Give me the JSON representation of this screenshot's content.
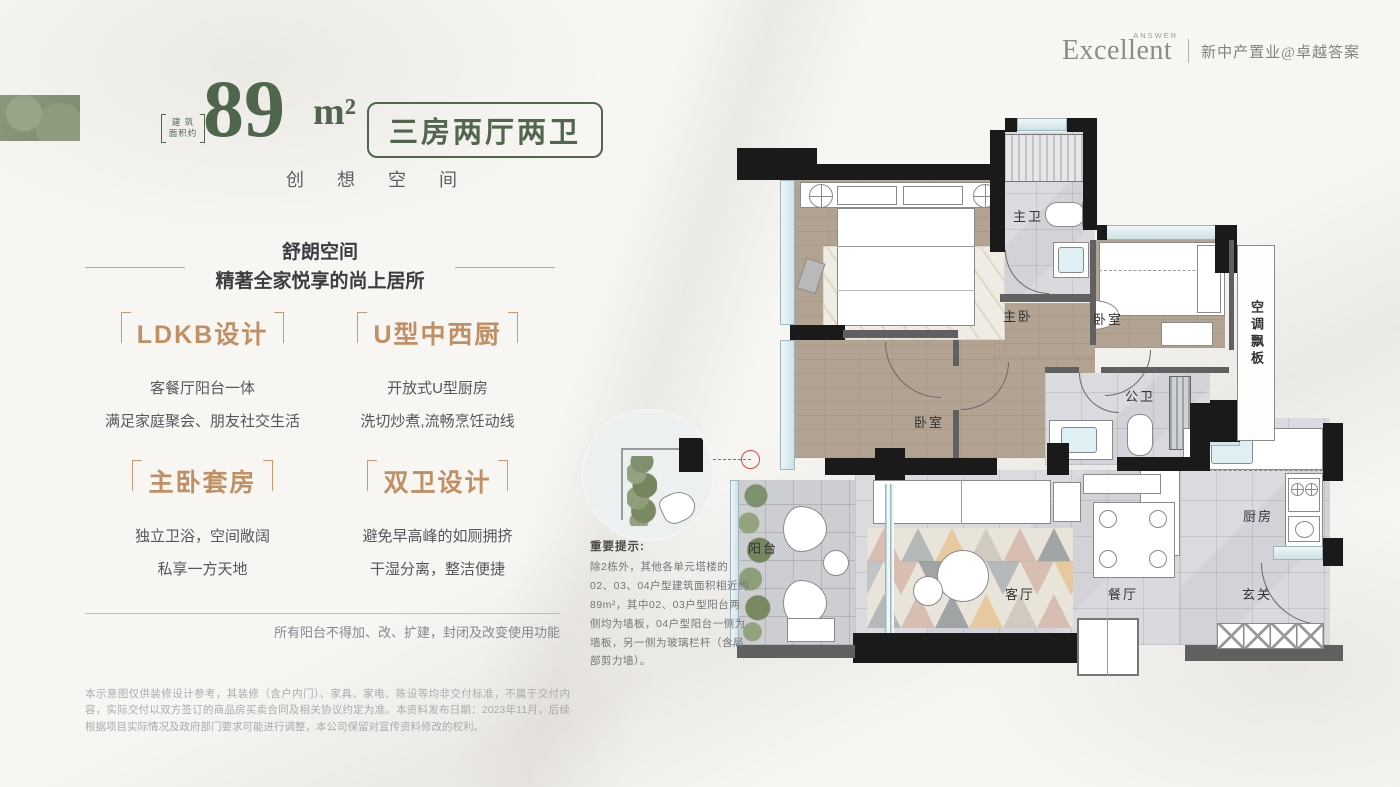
{
  "logo": {
    "brand": "Excellent",
    "brand_sub": "ANSWER",
    "tagline": "新中产置业@卓越答案"
  },
  "hero": {
    "area_label": "建 筑 面积约",
    "area_value": "89",
    "area_unit": "m²",
    "layout_badge": "三房两厅两卫",
    "slogan": "创 想 空 间"
  },
  "intro": {
    "line1": "舒朗空间",
    "line2": "精著全家悦享的尚上居所"
  },
  "features": [
    {
      "title": "LDKB设计",
      "desc1": "客餐厅阳台一体",
      "desc2": "满足家庭聚会、朋友社交生活"
    },
    {
      "title": "U型中西厨",
      "desc1": "开放式U型厨房",
      "desc2": "洗切炒煮,流畅烹饪动线"
    },
    {
      "title": "主卧套房",
      "desc1": "独立卫浴，空间敞阔",
      "desc2": "私享一方天地"
    },
    {
      "title": "双卫设计",
      "desc1": "避免早高峰的如厕拥挤",
      "desc2": "干湿分离，整洁便捷"
    }
  ],
  "balcony_note": "所有阳台不得加、改、扩建，封闭及改变使用功能",
  "disclaimer": "本示意图仅供装修设计参考，其装修（含户内门）、家具、家电、陈设等均非交付标准，不属于交付内容，实际交付以双方签订的商品房买卖合同及相关协议约定为准。本资料发布日期：2023年11月，后续根据项目实际情况及政府部门要求可能进行调整，本公司保留对宣传资料修改的权利。",
  "floorplan": {
    "labels": {
      "master_bath": "主卫",
      "master_bed": "主卧",
      "bedroom_right": "卧室",
      "bedroom_left": "卧室",
      "public_bath": "公卫",
      "ac_panel": "空调飘板",
      "balcony": "阳台",
      "living": "客厅",
      "dining": "餐厅",
      "kitchen": "厨房",
      "foyer": "玄关"
    },
    "note_title": "重要提示:",
    "note_body": "除2栋外，其他各单元塔楼的02、03、04户型建筑面积相近约89m²，其中02、03户型阳台两侧均为墙板，04户型阳台一侧为墙板，另一侧为玻璃栏杆（含局部剪力墙）。"
  }
}
